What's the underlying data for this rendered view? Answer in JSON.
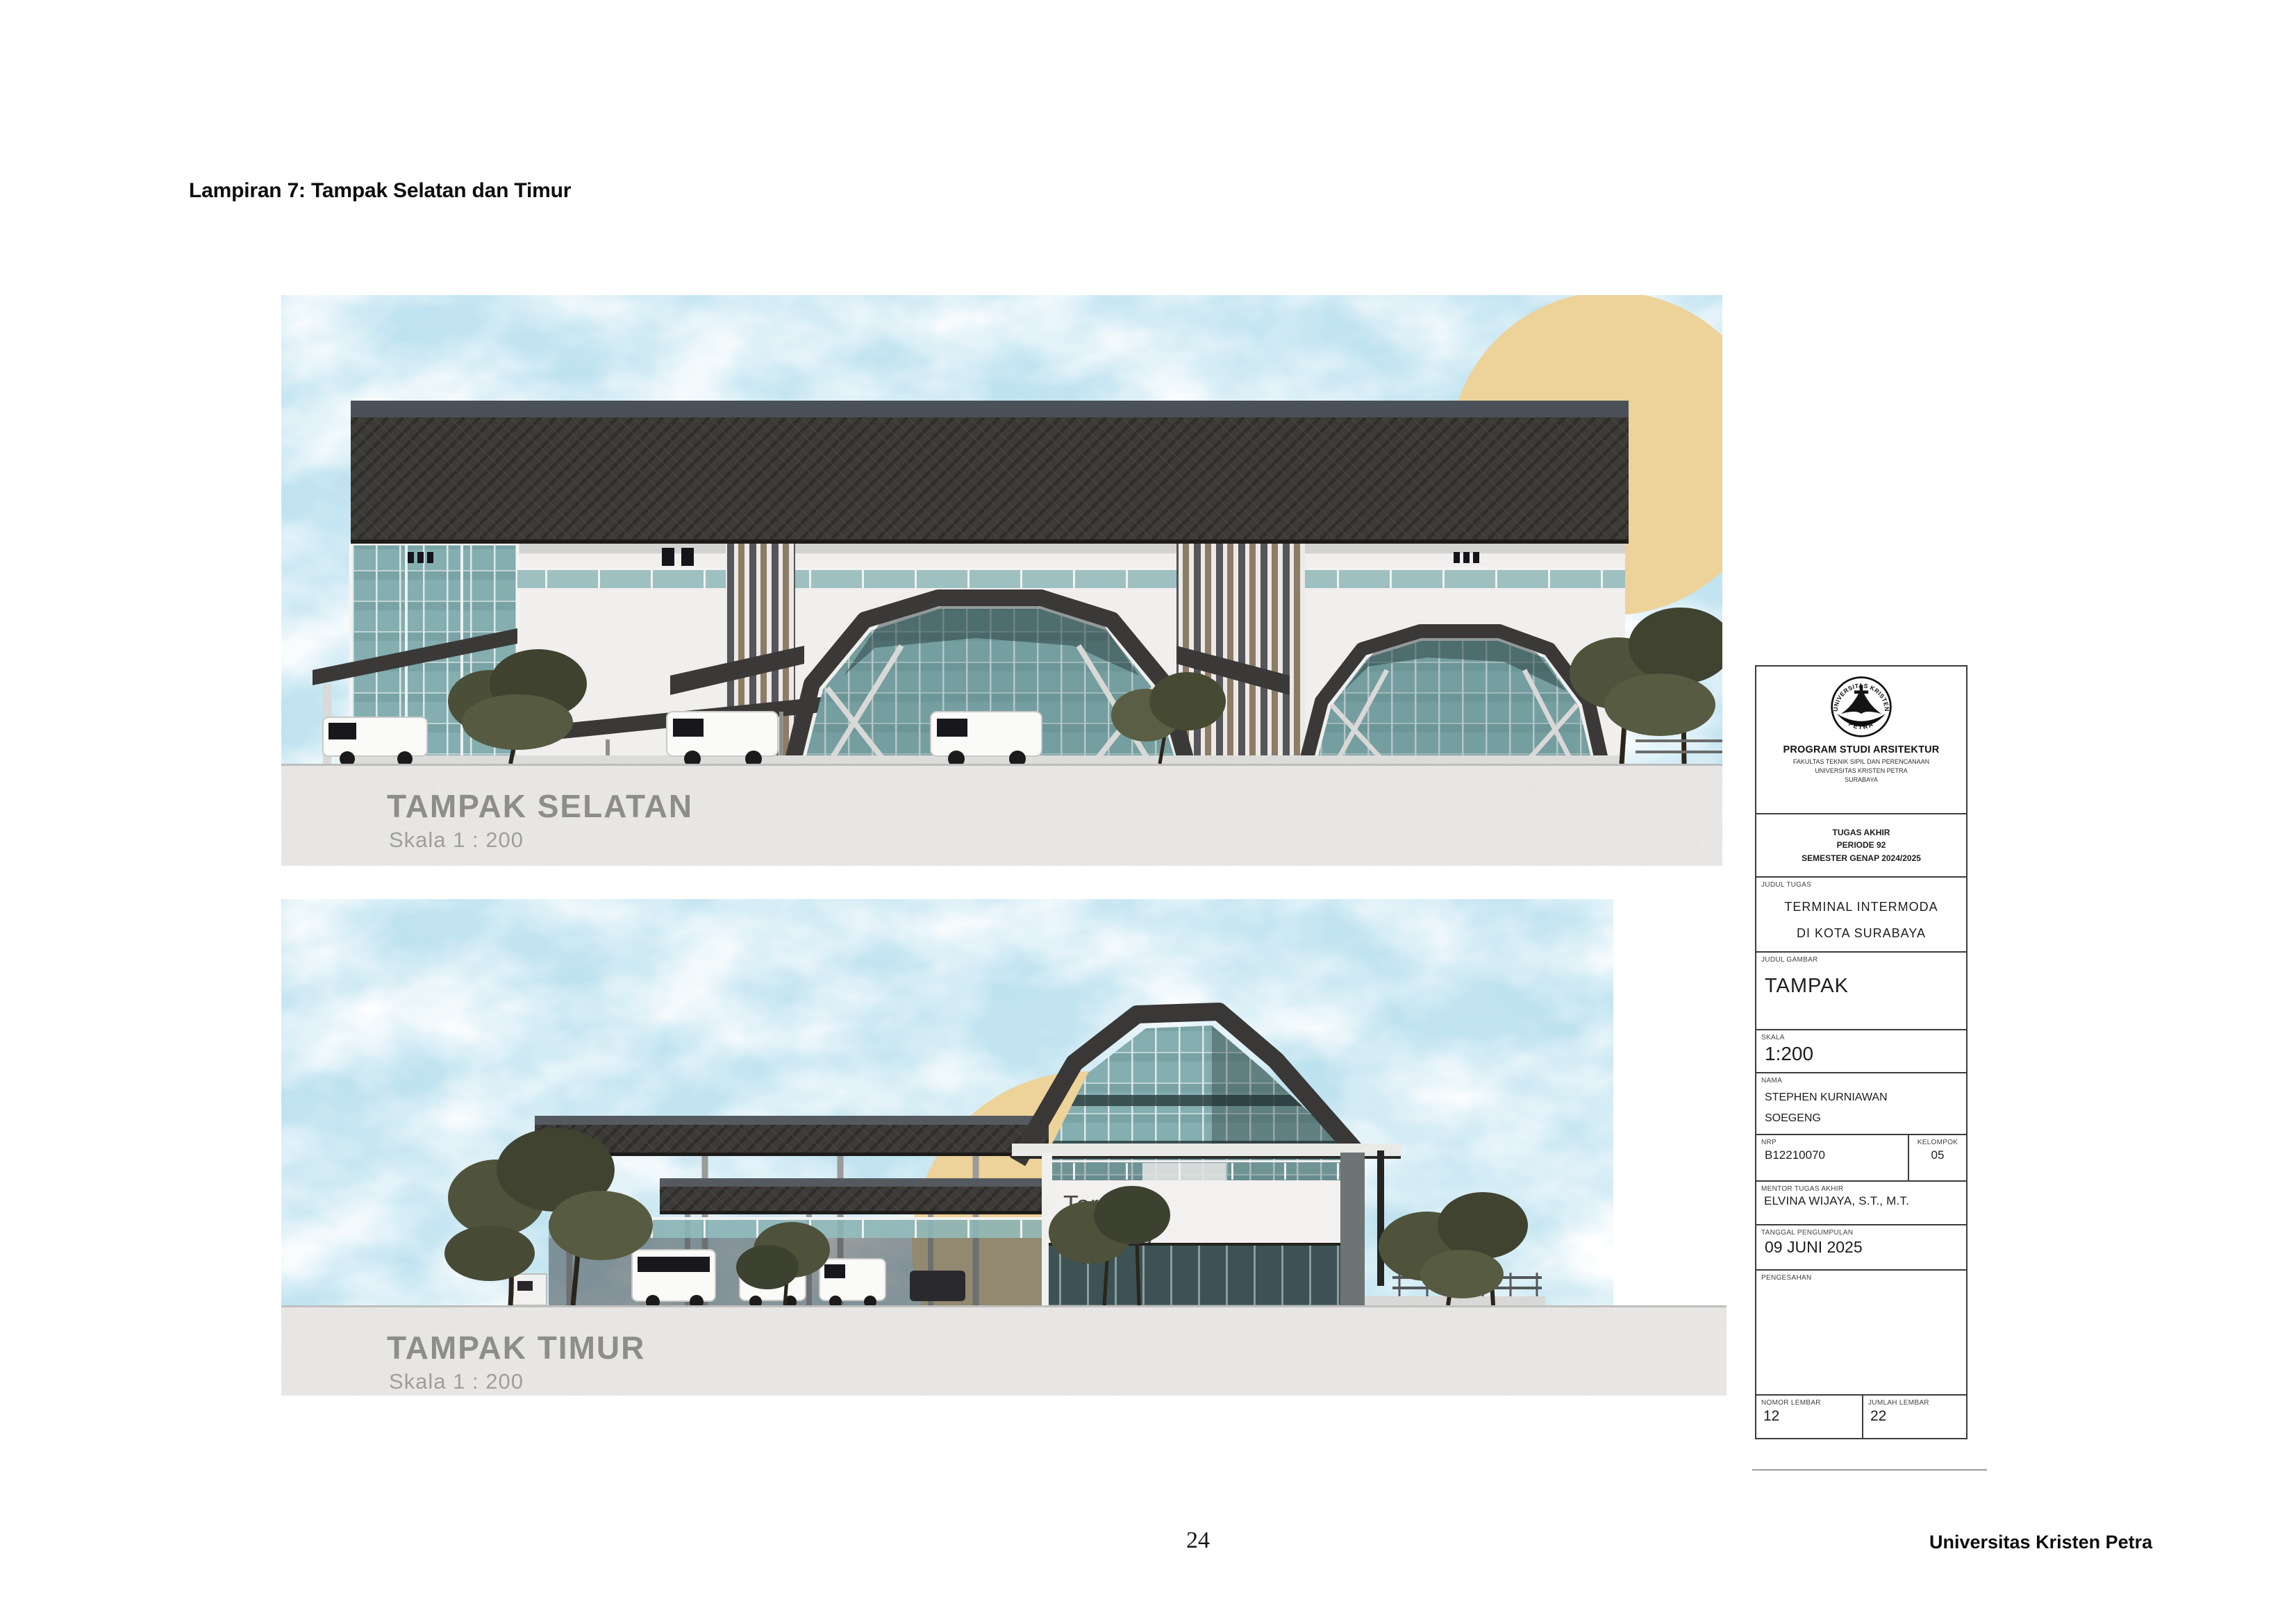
{
  "page": {
    "heading": "Lampiran 7: Tampak Selatan dan Timur",
    "page_number": "24",
    "footer_right": "Universitas Kristen Petra"
  },
  "drawings": {
    "south": {
      "title": "TAMPAK SELATAN",
      "scale": "Skala 1 : 200"
    },
    "east": {
      "title": "TAMPAK TIMUR",
      "scale": "Skala 1 : 200",
      "sign_line1": "Terminal",
      "sign_line2": "Bratang"
    }
  },
  "title_block": {
    "logo_arc_top": "UNIVERSITAS KRISTEN",
    "logo_arc_bottom": "PETRA",
    "program": "PROGRAM STUDI ARSITEKTUR",
    "faculty": [
      "FAKULTAS TEKNIK SIPIL DAN PERENCANAAN",
      "UNIVERSITAS KRISTEN PETRA",
      "SURABAYA"
    ],
    "assignment": [
      "TUGAS AKHIR",
      "PERIODE 92",
      "SEMESTER GENAP 2024/2025"
    ],
    "judul_tugas_label": "JUDUL TUGAS",
    "judul_tugas": [
      "TERMINAL INTERMODA",
      "DI KOTA SURABAYA"
    ],
    "judul_gambar_label": "JUDUL GAMBAR",
    "judul_gambar": "TAMPAK",
    "skala_label": "SKALA",
    "skala": "1:200",
    "nama_label": "NAMA",
    "nama": [
      "STEPHEN KURNIAWAN",
      "SOEGENG"
    ],
    "nrp_label": "NRP",
    "nrp": "B12210070",
    "kelompok_label": "KELOMPOK",
    "kelompok": "05",
    "mentor_label": "MENTOR TUGAS AKHIR",
    "mentor": "ELVINA WIJAYA, S.T., M.T.",
    "tanggal_label": "TANGGAL PENGUMPULAN",
    "tanggal": "09 JUNI 2025",
    "pengesahan_label": "PENGESAHAN",
    "nomor_lembar_label": "NOMOR LEMBAR",
    "nomor_lembar": "12",
    "jumlah_lembar_label": "JUMLAH LEMBAR",
    "jumlah_lembar": "22"
  },
  "colors": {
    "sky": "#c2e4f1",
    "sun": "#edd299",
    "roof": "#3c3b39",
    "glass": "#84aeb0",
    "louver_tan": "#8d7c66",
    "concrete": "#e7e6e4",
    "drawing_label": "#8d8d8b"
  }
}
